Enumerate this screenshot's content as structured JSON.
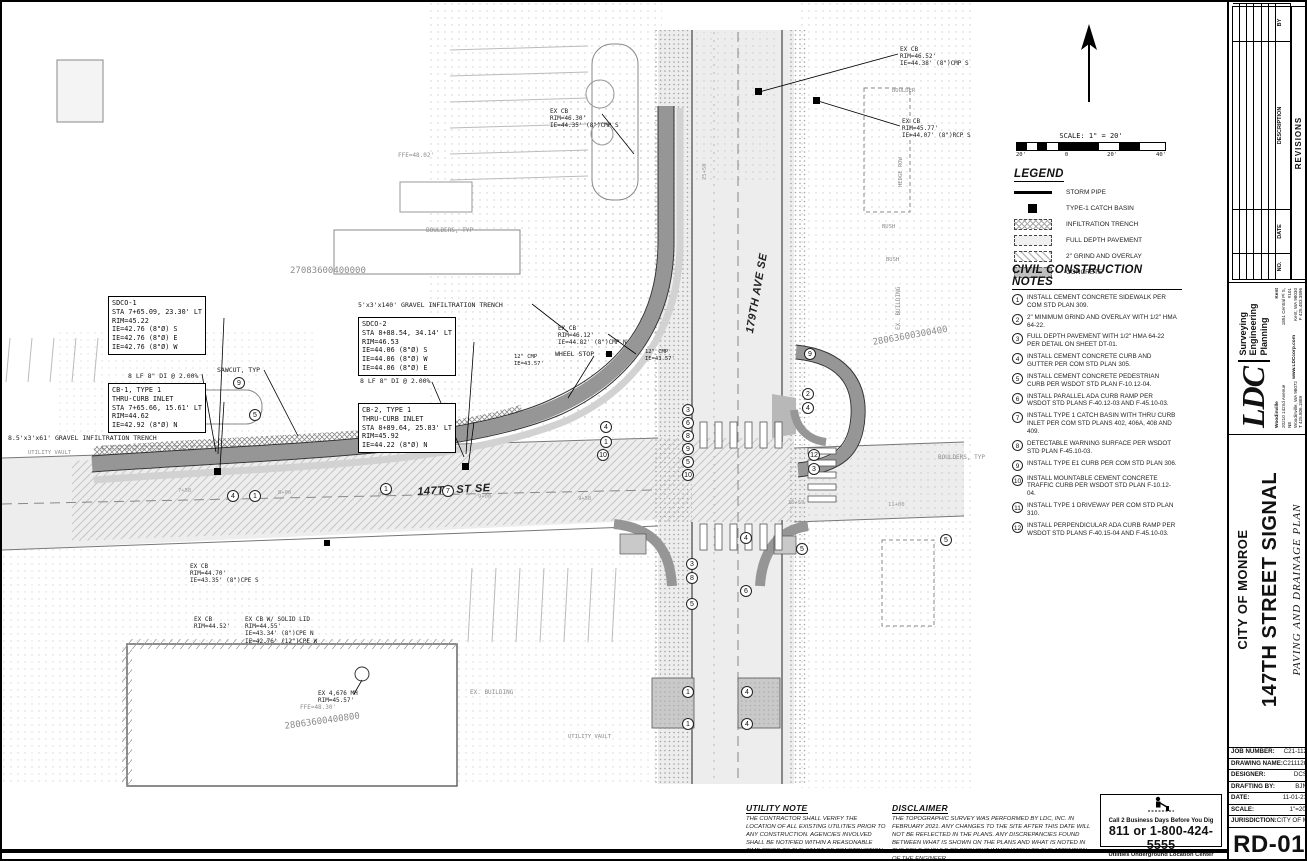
{
  "scalebar": {
    "label": "SCALE: 1\" = 20'",
    "ticks": [
      "20'",
      "0",
      "20'",
      "40'"
    ]
  },
  "legend": {
    "title": "LEGEND",
    "items": [
      {
        "key": "storm-pipe",
        "label": "STORM PIPE"
      },
      {
        "key": "catch-basin",
        "label": "TYPE-1 CATCH BASIN"
      },
      {
        "key": "infiltration-trench",
        "label": "INFILTRATION TRENCH"
      },
      {
        "key": "full-depth",
        "label": "FULL DEPTH PAVEMENT"
      },
      {
        "key": "grind-overlay",
        "label": "2\" GRIND AND OVERLAY"
      },
      {
        "key": "concrete",
        "label": "CONCRETE"
      }
    ]
  },
  "notes": {
    "title": "CIVIL CONSTRUCTION NOTES",
    "items": [
      {
        "num": "1",
        "text": "INSTALL CEMENT CONCRETE SIDEWALK PER COM STD PLAN 309."
      },
      {
        "num": "2",
        "text": "2\" MINIMUM GRIND AND OVERLAY WITH 1/2\" HMA 64-22."
      },
      {
        "num": "3",
        "text": "FULL DEPTH PAVEMENT WITH 1/2\" HMA 64-22 PER DETAIL ON SHEET DT-01."
      },
      {
        "num": "4",
        "text": "INSTALL CEMENT CONCRETE CURB AND GUTTER PER COM STD PLAN 305."
      },
      {
        "num": "5",
        "text": "INSTALL CEMENT CONCRETE PEDESTRIAN CURB PER WSDOT STD PLAN F-10.12-04."
      },
      {
        "num": "6",
        "text": "INSTALL PARALLEL ADA CURB RAMP PER WSDOT STD PLANS F-40.12-03 AND F-45.10-03."
      },
      {
        "num": "7",
        "text": "INSTALL TYPE 1 CATCH BASIN WITH THRU CURB INLET PER COM STD PLANS 402, 406A, 408 AND 409."
      },
      {
        "num": "8",
        "text": "DETECTABLE WARNING SURFACE PER WSDOT STD PLAN F-45.10-03."
      },
      {
        "num": "9",
        "text": "INSTALL TYPE E1 CURB PER COM STD PLAN 306."
      },
      {
        "num": "10",
        "text": "INSTALL MOUNTABLE CEMENT CONCRETE TRAFFIC CURB PER WSDOT STD PLAN F-10.12-04."
      },
      {
        "num": "11",
        "text": "INSTALL TYPE 1 DRIVEWAY PER COM STD PLAN 310."
      },
      {
        "num": "12",
        "text": "INSTALL PERPENDICULAR ADA CURB RAMP PER WSDOT STD PLANS F-40.15-04 AND F-45.10-03."
      }
    ]
  },
  "utility_note": {
    "title": "UTILITY NOTE",
    "text": "THE CONTRACTOR SHALL VERIFY THE LOCATION OF ALL EXISTING UTILITIES PRIOR TO ANY CONSTRUCTION. AGENCIES INVOLVED SHALL BE NOTIFIED WITHIN A REASONABLE TIME PRIOR TO THE START OF CONSTRUCTION."
  },
  "disclaimer": {
    "title": "DISCLAIMER",
    "text": "THE TOPOGRAPHIC SURVEY WAS PERFORMED BY LDC, INC. IN FEBRUARY 2021. ANY CHANGES TO THE SITE AFTER THIS DATE WILL NOT BE REFLECTED IN THE PLANS. ANY DISCREPANCIES FOUND BETWEEN WHAT IS SHOWN ON THE PLANS AND WHAT IS NOTED IN THE FIELD SHOULD BE BROUGHT IMMEDIATELY TO THE ATTENTION OF THE ENGINEER."
  },
  "call_before_dig": {
    "line1": "Call 2 Business Days Before You Dig",
    "line2": "811 or 1-800-424-5555",
    "line3": "Utilities Underground Location Center"
  },
  "titleblock": {
    "revisions": {
      "title": "REVISIONS",
      "columns": [
        "NO.",
        "DATE",
        "DESCRIPTION",
        "BY"
      ],
      "empty_rows": 6
    },
    "firm": {
      "name": "LDC",
      "services": [
        "Surveying",
        "Engineering",
        "Planning"
      ],
      "office1": {
        "city": "Woodinville",
        "addr1": "20210 142nd Avenue NE",
        "addr2": "Woodinville, WA 98072",
        "phone": "T 425.806.1869"
      },
      "office2": {
        "city": "Kent",
        "addr1": "1851 Central Pl S, #101",
        "addr2": "Kent, WA 98030",
        "phone": "F 425.483.3896"
      },
      "website": "www.LDCcorp.com"
    },
    "client": "CITY OF MONROE",
    "project": "147TH STREET SIGNAL",
    "sheet_title": "PAVING AND DRAINAGE PLAN",
    "info": [
      {
        "label": "JOB NUMBER:",
        "value": "C21-112"
      },
      {
        "label": "DRAWING NAME:",
        "value": "C21112C-RD-PL"
      },
      {
        "label": "DESIGNER:",
        "value": "DCS"
      },
      {
        "label": "DRAFTING BY:",
        "value": "BJN"
      },
      {
        "label": "DATE:",
        "value": "11-01-21"
      },
      {
        "label": "SCALE:",
        "value": "1\"=20'"
      },
      {
        "label": "JURISDICTION:",
        "value": "CITY OF MONROE"
      }
    ],
    "sheet_no": "RD-01",
    "sheet_label": "SHEET",
    "of_label": "OF"
  },
  "plan": {
    "callouts": [
      {
        "x": 106,
        "y": 294,
        "lines": [
          "SDCO-1",
          "STA 7+65.09, 23.30' LT",
          "RIM=45.22",
          "IE=42.76 (8\"Ø) S",
          "IE=42.76 (8\"Ø) E",
          "IE=42.76 (8\"Ø) W"
        ]
      },
      {
        "x": 106,
        "y": 381,
        "lines": [
          "CB-1, TYPE 1",
          "THRU-CURB INLET",
          "STA 7+65.66, 15.61' LT",
          "RIM=44.62",
          "IE=42.92 (8\"Ø) N"
        ]
      },
      {
        "x": 356,
        "y": 315,
        "lines": [
          "SDCO-2",
          "STA 8+88.54, 34.14' LT",
          "RIM=46.53",
          "IE=44.06 (8\"Ø) S",
          "IE=44.06 (8\"Ø) W",
          "IE=44.06 (8\"Ø) E"
        ]
      },
      {
        "x": 356,
        "y": 401,
        "lines": [
          "CB-2, TYPE 1",
          "THRU-CURB INLET",
          "STA 8+89.64, 25.83' LT",
          "RIM=45.92",
          "IE=44.22 (8\"Ø) N"
        ]
      }
    ],
    "labels": [
      {
        "t": "27083600400000",
        "x": 288,
        "y": 264,
        "s": 9,
        "c": "gray"
      },
      {
        "t": "28063600300400",
        "x": 870,
        "y": 336,
        "s": 9,
        "r": -10,
        "c": "gray"
      },
      {
        "t": "28063600400800",
        "x": 282,
        "y": 720,
        "s": 9,
        "r": -8,
        "c": "gray"
      },
      {
        "t": "147TH ST SE",
        "x": 415,
        "y": 484,
        "s": 11,
        "r": -3,
        "c": "street"
      },
      {
        "t": "179TH AVE SE",
        "x": 742,
        "y": 330,
        "s": 11,
        "r": -80,
        "c": "street"
      },
      {
        "t": "5'x3'x140' GRAVEL INFILTRATION TRENCH",
        "x": 356,
        "y": 300,
        "s": 6.5
      },
      {
        "t": "8.5'x3'x61' GRAVEL INFILTRATION TRENCH",
        "x": 6,
        "y": 433,
        "s": 6.5
      },
      {
        "t": "8 LF 8\" DI @ 2.00%",
        "x": 126,
        "y": 371,
        "s": 6.5
      },
      {
        "t": "8 LF 8\" DI @ 2.00%",
        "x": 358,
        "y": 376,
        "s": 6.5
      },
      {
        "t": "SAWCUT, TYP",
        "x": 215,
        "y": 365,
        "s": 6.5
      },
      {
        "t": "WHEEL STOP",
        "x": 553,
        "y": 349,
        "s": 6.5
      },
      {
        "t": "UTILITY VAULT",
        "x": 26,
        "y": 448,
        "s": 5.5,
        "c": "gray"
      },
      {
        "t": "UTILITY VAULT",
        "x": 566,
        "y": 732,
        "s": 5.5,
        "c": "gray"
      },
      {
        "t": "BOULDERS, TYP",
        "x": 424,
        "y": 225,
        "s": 6,
        "c": "gray"
      },
      {
        "t": "BOULDERS, TYP",
        "x": 936,
        "y": 452,
        "s": 6,
        "c": "gray"
      },
      {
        "t": "BOULDER",
        "x": 890,
        "y": 86,
        "s": 5.5,
        "c": "gray"
      },
      {
        "t": "HEDGE ROW",
        "x": 896,
        "y": 185,
        "s": 5.5,
        "r": -90,
        "c": "gray"
      },
      {
        "t": "BUSH",
        "x": 880,
        "y": 222,
        "s": 5.5,
        "c": "gray"
      },
      {
        "t": "BUSH",
        "x": 884,
        "y": 255,
        "s": 5.5,
        "c": "gray"
      },
      {
        "t": "EX CB\nRIM=46.52'\nIE=44.38' (8\")CMP S",
        "x": 898,
        "y": 44,
        "s": 6
      },
      {
        "t": "EX CB\nRIM=45.77'\nIE=44.07' (8\")RCP S",
        "x": 900,
        "y": 116,
        "s": 6
      },
      {
        "t": "EX CB\nRIM=46.30'\nIE=44.35' (8\")CMP S",
        "x": 548,
        "y": 106,
        "s": 6
      },
      {
        "t": "EX CB\nRIM=46.12'\nIE=44.82' (8\")CMP N",
        "x": 556,
        "y": 323,
        "s": 6
      },
      {
        "t": "12\" CMP\nIE=43.57'",
        "x": 512,
        "y": 352,
        "s": 5.5
      },
      {
        "t": "12\" CMP\nIE=43.57'",
        "x": 643,
        "y": 347,
        "s": 5.5
      },
      {
        "t": "EX CB\nRIM=44.70'\nIE=43.35' (8\")CPE S",
        "x": 188,
        "y": 561,
        "s": 6
      },
      {
        "t": "EX CB\nRIM=44.52'",
        "x": 192,
        "y": 614,
        "s": 6
      },
      {
        "t": "EX CB W/ SOLID LID\nRIM=44.55'\nIE=43.34' (8\")CPE N\nIE=42.76' (12\")CPE W",
        "x": 243,
        "y": 614,
        "s": 6
      },
      {
        "t": "EX 4,676 MH\nRIM=45.57'",
        "x": 316,
        "y": 688,
        "s": 6
      },
      {
        "t": "FFE=48.02'",
        "x": 396,
        "y": 150,
        "s": 6,
        "c": "gray"
      },
      {
        "t": "FFE=48.30'",
        "x": 298,
        "y": 702,
        "s": 6,
        "c": "gray"
      },
      {
        "t": "EX. BUILDING",
        "x": 468,
        "y": 687,
        "s": 6,
        "c": "gray"
      },
      {
        "t": "EX. BUILDING",
        "x": 893,
        "y": 328,
        "s": 6,
        "r": -90,
        "c": "gray"
      },
      {
        "t": "7+50",
        "x": 176,
        "y": 486,
        "c": "sta"
      },
      {
        "t": "8+00",
        "x": 276,
        "y": 488,
        "c": "sta"
      },
      {
        "t": "8+50",
        "x": 376,
        "y": 490,
        "c": "sta"
      },
      {
        "t": "9+00",
        "x": 476,
        "y": 492,
        "c": "sta"
      },
      {
        "t": "9+50",
        "x": 576,
        "y": 494,
        "c": "sta"
      },
      {
        "t": "10+50",
        "x": 786,
        "y": 498,
        "c": "sta"
      },
      {
        "t": "11+00",
        "x": 886,
        "y": 500,
        "c": "sta"
      },
      {
        "t": "25+50",
        "x": 700,
        "y": 178,
        "r": -90,
        "c": "sta"
      }
    ],
    "markers": [
      {
        "n": "9",
        "x": 231,
        "y": 375
      },
      {
        "n": "5",
        "x": 247,
        "y": 407
      },
      {
        "n": "4",
        "x": 225,
        "y": 488
      },
      {
        "n": "1",
        "x": 247,
        "y": 488
      },
      {
        "n": "1",
        "x": 378,
        "y": 481
      },
      {
        "n": "7",
        "x": 440,
        "y": 483
      },
      {
        "n": "4",
        "x": 598,
        "y": 419
      },
      {
        "n": "1",
        "x": 598,
        "y": 434
      },
      {
        "n": "10",
        "x": 595,
        "y": 447
      },
      {
        "n": "3",
        "x": 680,
        "y": 402
      },
      {
        "n": "6",
        "x": 680,
        "y": 415
      },
      {
        "n": "8",
        "x": 680,
        "y": 428
      },
      {
        "n": "9",
        "x": 680,
        "y": 441
      },
      {
        "n": "5",
        "x": 680,
        "y": 454
      },
      {
        "n": "10",
        "x": 680,
        "y": 467
      },
      {
        "n": "9",
        "x": 802,
        "y": 346
      },
      {
        "n": "2",
        "x": 800,
        "y": 386
      },
      {
        "n": "4",
        "x": 800,
        "y": 400
      },
      {
        "n": "12",
        "x": 806,
        "y": 447
      },
      {
        "n": "3",
        "x": 806,
        "y": 461
      },
      {
        "n": "5",
        "x": 938,
        "y": 532
      },
      {
        "n": "4",
        "x": 738,
        "y": 530
      },
      {
        "n": "5",
        "x": 794,
        "y": 541
      },
      {
        "n": "3",
        "x": 684,
        "y": 556
      },
      {
        "n": "8",
        "x": 684,
        "y": 570
      },
      {
        "n": "6",
        "x": 738,
        "y": 583
      },
      {
        "n": "5",
        "x": 684,
        "y": 596
      },
      {
        "n": "1",
        "x": 680,
        "y": 684
      },
      {
        "n": "4",
        "x": 739,
        "y": 684
      },
      {
        "n": "1",
        "x": 680,
        "y": 716
      },
      {
        "n": "4",
        "x": 739,
        "y": 716
      }
    ]
  }
}
